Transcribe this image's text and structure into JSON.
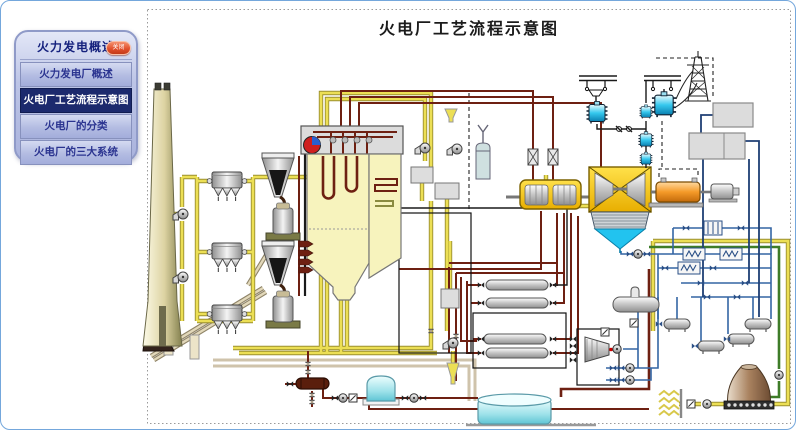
{
  "sidebar": {
    "title": "火力发电概述",
    "close_label": "关闭",
    "items": [
      {
        "label": "火力发电厂概述",
        "active": false
      },
      {
        "label": "火电厂工艺流程示意图",
        "active": true
      },
      {
        "label": "火电厂的分类",
        "active": false
      },
      {
        "label": "火电厂的三大系统",
        "active": false
      }
    ]
  },
  "diagram": {
    "title": "火电厂工艺流程示意图",
    "components": [
      "chimney",
      "electrostatic-precipitator-1",
      "electrostatic-precipitator-2",
      "electrostatic-precipitator-3",
      "induced-draft-fan-1",
      "induced-draft-fan-2",
      "coal-pile",
      "coal-conveyor",
      "coal-bunker-1",
      "coal-bunker-2",
      "coal-mill-1",
      "coal-mill-2",
      "boiler",
      "steam-drum",
      "superheater-tubes",
      "economizer-coils",
      "burners",
      "air-heater-1",
      "air-heater-2",
      "forced-draft-fan",
      "air-intake-funnel",
      "main-steam-valves",
      "hp-turbine",
      "lp-turbine",
      "condenser",
      "generator",
      "exciter",
      "step-up-transformer-1",
      "step-up-transformer-2",
      "auxiliary-transformers",
      "busbar-1",
      "busbar-2",
      "transmission-tower",
      "plant-buildings",
      "feedwater-heater-1",
      "feedwater-heater-2",
      "feedwater-heater-3",
      "feedwater-heater-4",
      "deaerator",
      "feed-pump-turbine",
      "feed-pumps",
      "condensate-pump",
      "water-heat-exchangers",
      "oil-water-tanks",
      "cooling-tower",
      "water-intake-screen",
      "circulating-pump",
      "water-reservoir-tank",
      "condensate-tank",
      "blowdown-vessel",
      "drain-funnel"
    ]
  },
  "palette": {
    "pipeYellow": "#ecdf55",
    "pipeYellowDark": "#9b8f2e",
    "pipeSteam": "#6e2012",
    "pipeWater": "#3465a4",
    "pipeWaterDark": "#1f3f74",
    "pipeGreen": "#3e7c28",
    "pipeFeed": "#cfc3ab",
    "turbineYellow": "#f6c80a",
    "generatorOrange": "#f59a28",
    "transformerCyan": "#35c8ee",
    "condenserCyan": "#22c3ef",
    "boilerFill": "#f7f3bd",
    "chimneyTan": "#ddd3a2",
    "coolingTowerBrown": "#a9825f",
    "sidebarActiveBg": "#1c2a6d",
    "sidebarActiveText": "#ffffff",
    "sidebarText": "#2b3490",
    "closeRed": "#e4502e",
    "pageBorder": "#74a7dc"
  }
}
